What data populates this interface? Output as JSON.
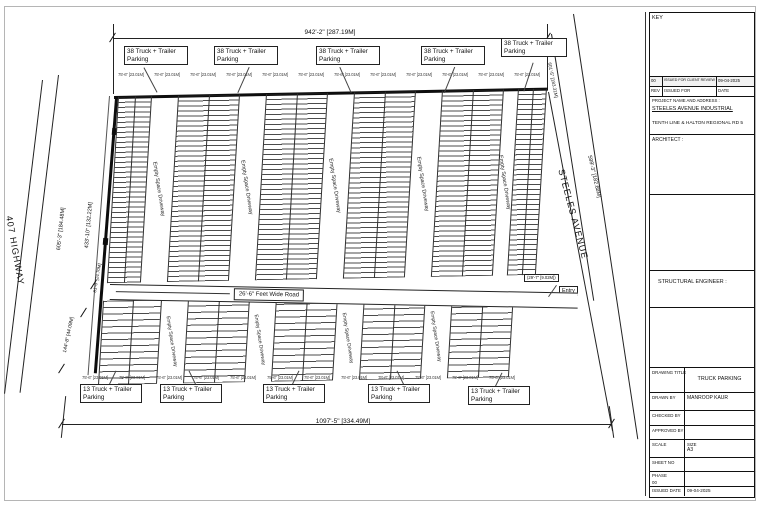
{
  "drawing": {
    "top_dimension": "942'-2\" [287.19M]",
    "bottom_dimension": "1097'-5\" [334.49M]",
    "bay_dimension": "75'-6\" [23.01M]",
    "top_parking_sign": "38 Truck + Trailer Parking",
    "bottom_parking_sign": "13 Truck + Trailer Parking",
    "road_label": "26'-6\" Feet Wide Road",
    "left_street": "407 HIGHWAY",
    "right_street": "STEELES AVENUE",
    "driveway_label": "Empty Space Driveway",
    "entry_label": "Entry",
    "dim_left_outer": "605'-3\" [184.48M]",
    "dim_left_inner": "433'-10\" [132.22M]",
    "dim_left_lower": "144'-8\" [44.09M]",
    "dim_left_small": "81'-0\" [24.70M]",
    "dim_right_outer": "599'-3\" [182.68M]",
    "dim_right_inner": "601'-5\" [183.31M]",
    "dim_entry_upper": "(29'-7\" [9.02M])",
    "dim_entry_lower": "178'-10\" [54.50M]"
  },
  "titleblock": {
    "key_label": "KEY",
    "revision_entry": {
      "rev": "00",
      "issued_for": "ISSUED FOR CLIENT REVIEW",
      "date": "09-04-2025"
    },
    "revision_header": {
      "rev": "REV",
      "issued_for": "ISSUED FOR",
      "date": "DATE"
    },
    "project_heading": "PROJECT NAME AND ADDRESS :",
    "project_name": "STEELES AVENUE  INDUSTRIAL",
    "project_address": "TENTH LINE & HALTON REGIONAL RD 5",
    "architect_label": "ARCHITECT :",
    "structural_label": "STRUCTURAL ENGINEER :",
    "fields": {
      "drawing_title_label": "DRAWING TITLE",
      "drawing_title": "TRUCK PARKING",
      "drawn_by_label": "DRAWN BY",
      "drawn_by": "MANROOP KAUR",
      "checked_by_label": "CHECKED BY",
      "approved_by_label": "APPROVED BY",
      "scale_label": "SCALE",
      "size_label": "SIZE",
      "size_value": "A3",
      "sheet_no_label": "SHEET NO",
      "phase_label": "PHASE",
      "phase_value": "00",
      "issued_date_label": "ISSUED DATE",
      "issued_date": "09-04-2025"
    }
  }
}
